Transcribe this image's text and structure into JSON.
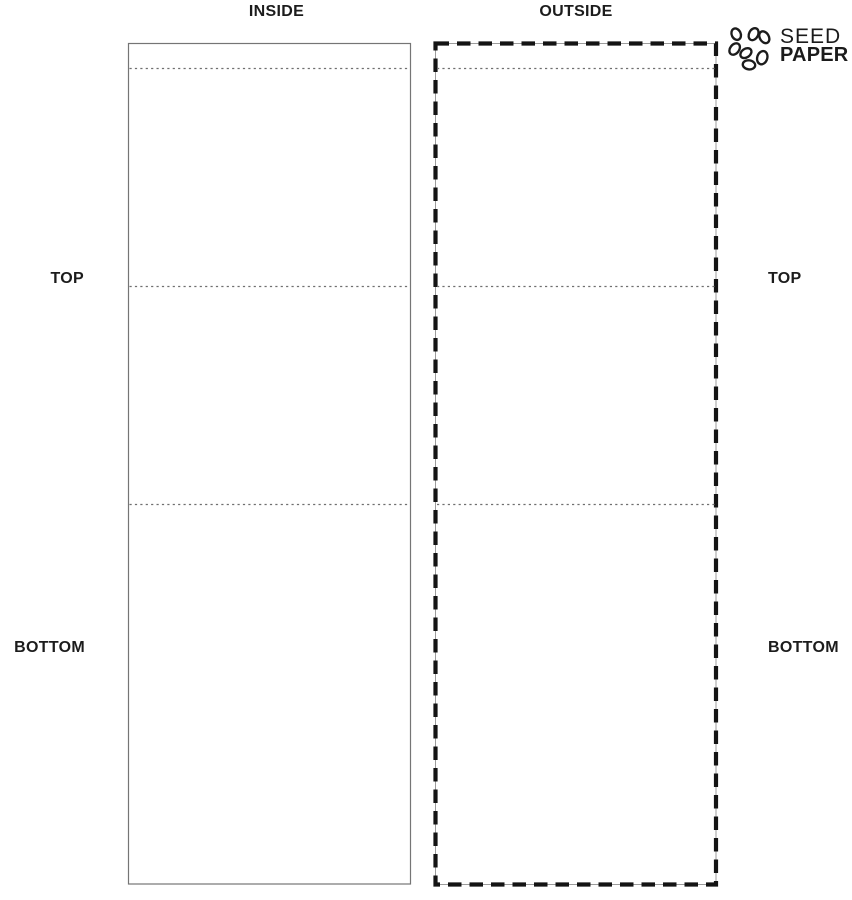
{
  "canvas": {
    "width": 852,
    "height": 900,
    "background": "#ffffff"
  },
  "colors": {
    "ink": "#1c1c1c",
    "cut_line": "#757575",
    "tear_line": "#141414",
    "thin_outline": "#9c9c9c",
    "fold_line": "#6f6f6f"
  },
  "panels": {
    "inside": {
      "title": "INSIDE",
      "border_style": "solid",
      "top_label": "TOP",
      "bottom_label": "BOTTOM"
    },
    "outside": {
      "title": "OUTSIDE",
      "border_style": "dashed",
      "top_label": "TOP",
      "bottom_label": "BOTTOM"
    }
  },
  "logo": {
    "name_line1": "SEED",
    "name_line2": "PAPER",
    "icon": "seed-cluster"
  }
}
